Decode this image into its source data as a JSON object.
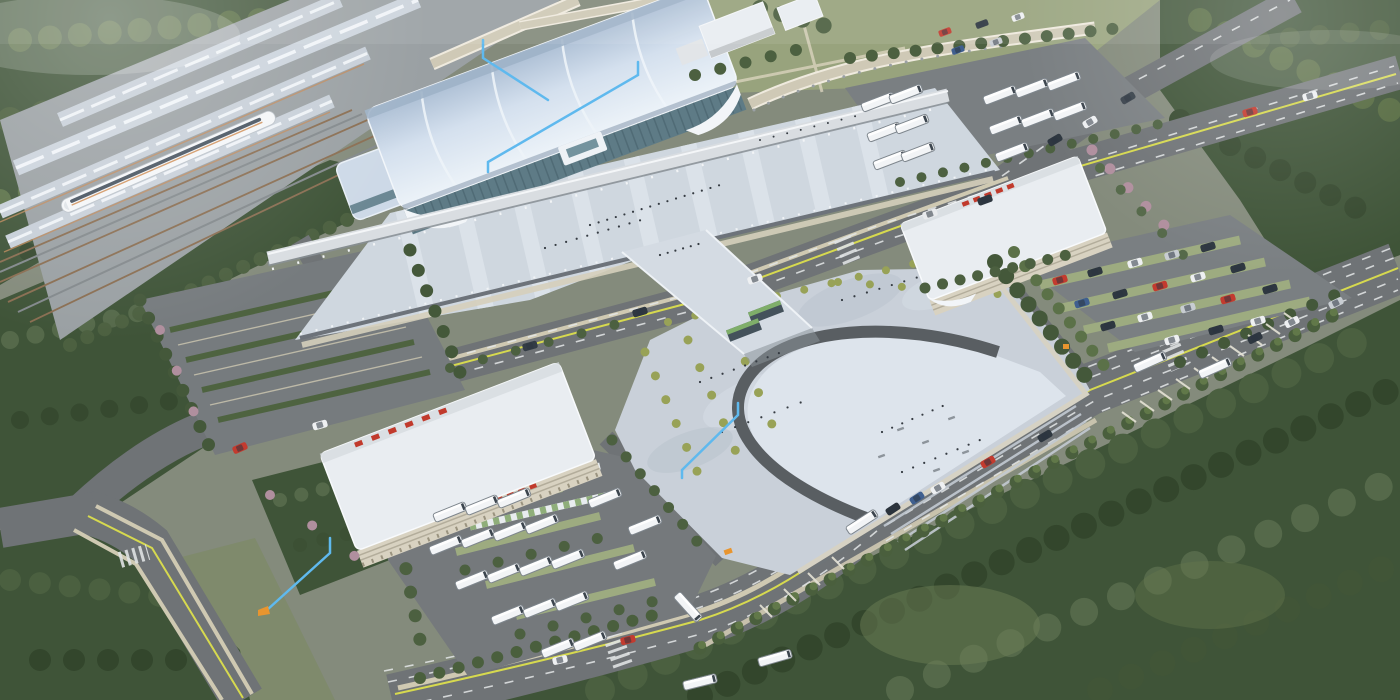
{
  "scene": {
    "type": "aerial-architectural-rendering",
    "subject": "railway-station-complex"
  },
  "colors": {
    "ground": "#848b7c",
    "lawn": "#98a37d",
    "forest": "#3f5438",
    "forest_dark": "#34472d",
    "forest_light": "#5b7047",
    "road": "#6f7376",
    "lane_yellow": "#d6d94f",
    "lane_white": "#e5e8e9",
    "sidewalk": "#cfc9b2",
    "plaza": "#c9d0d9",
    "plaza_light": "#dde4ec",
    "arch_ring": "#595e62",
    "deck": "#cfd7df",
    "deck_stripe": "#dde4eb",
    "station_roof": "#c2d2e4",
    "glass": "#5e7b86",
    "canopy": "#d9dde1",
    "platform_canopy": "#c7cfd8",
    "ballast": "#8a6e52",
    "train": "#f4f6f8",
    "building_roof": "#e9edf1",
    "facade": "#d8d2c1",
    "signage": "#c13a2c",
    "bus": "#f2f4f6",
    "stall_green": "#9dab80",
    "blossom": "#b08f9e",
    "people": "#353b42"
  },
  "annotations": {
    "color": "#5fb9ee",
    "marker_color": "#e8952f",
    "count": 4
  }
}
